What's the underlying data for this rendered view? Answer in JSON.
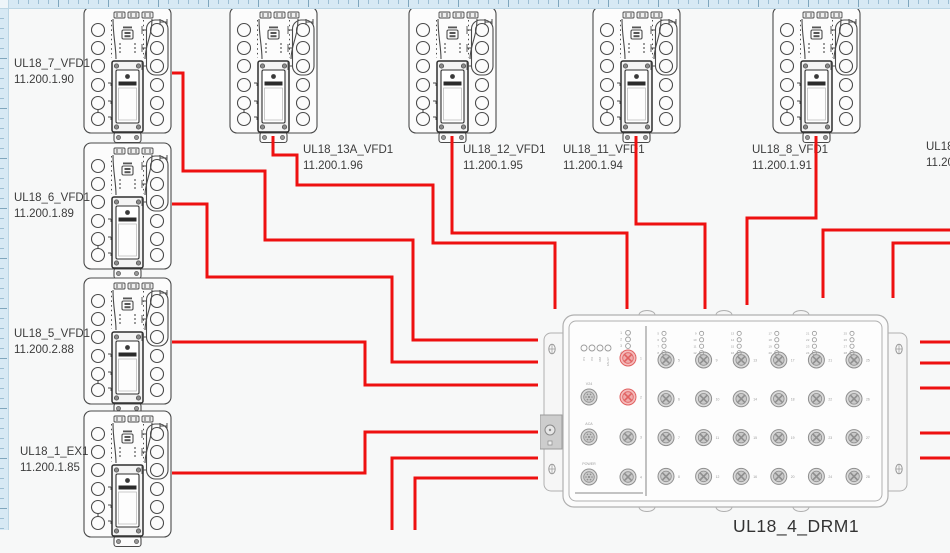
{
  "app": {
    "canvas_bg": "#f7f8f8",
    "ruler_color": "#d7e9f4",
    "outline_color": "#454545",
    "drm_outline_color": "#b0b0b0",
    "label_color": "#3c3c3c"
  },
  "devices": [
    {
      "name": "UL18_7_VFD1",
      "ip": "11.200.1.90",
      "x": 83,
      "y": 6,
      "label_x": 14,
      "label_y": 57
    },
    {
      "name": "UL18_6_VFD1",
      "ip": "11.200.1.89",
      "x": 83,
      "y": 142,
      "label_x": 14,
      "label_y": 191
    },
    {
      "name": "UL18_5_VFD1",
      "ip": "11.200.2.88",
      "x": 83,
      "y": 277,
      "label_x": 14,
      "label_y": 327
    },
    {
      "name": "UL18_1_EX1",
      "ip": "11.200.1.85",
      "x": 83,
      "y": 410,
      "label_x": 20,
      "label_y": 445
    },
    {
      "name": "UL18_13A_VFD1",
      "ip": "11.200.1.96",
      "x": 229,
      "y": 6,
      "label_x": 303,
      "label_y": 143
    },
    {
      "name": "UL18_12_VFD1",
      "ip": "11.200.1.95",
      "x": 408,
      "y": 6,
      "label_x": 463,
      "label_y": 143
    },
    {
      "name": "UL18_11_VFD1",
      "ip": "11.200.1.94",
      "x": 592,
      "y": 6,
      "label_x": 563,
      "label_y": 143
    },
    {
      "name": "UL18_8_VFD1",
      "ip": "11.200.1.91",
      "x": 772,
      "y": 6,
      "label_x": 752,
      "label_y": 143
    }
  ],
  "partial_device_label": {
    "name": "UL18",
    "ip": "11.20",
    "label_x": 926,
    "label_y": 140
  },
  "drm": {
    "title": "UL18_4_DRM1",
    "status_leds": [
      "P1",
      "P2",
      "RM",
      "FAULT"
    ],
    "left_led_numbers": [
      1,
      2,
      3,
      4
    ],
    "aux_port_labels": [
      "V24",
      "ACA",
      "POWER"
    ],
    "uplink_port_numbers": [
      1,
      2,
      3,
      4
    ],
    "highlighted_ports": [
      1,
      2
    ],
    "highlight_color": "#e06060",
    "highlight_fill": "#f5bcbc",
    "main_ports_first": 5,
    "main_ports_last": 28,
    "main_port_cols": 6,
    "main_port_rows": 4
  },
  "cables": {
    "color": "#ee1010",
    "width": 3,
    "routes": [
      {
        "id": "cable-ul18-7",
        "points": [
          [
            172,
            73
          ],
          [
            183,
            73
          ],
          [
            183,
            171
          ],
          [
            265,
            171
          ],
          [
            265,
            240
          ],
          [
            413,
            240
          ],
          [
            413,
            340
          ],
          [
            538,
            340
          ]
        ]
      },
      {
        "id": "cable-ul18-6",
        "points": [
          [
            172,
            204
          ],
          [
            207,
            204
          ],
          [
            207,
            277
          ],
          [
            392,
            277
          ],
          [
            392,
            362
          ],
          [
            538,
            362
          ]
        ]
      },
      {
        "id": "cable-ul18-5",
        "points": [
          [
            172,
            342
          ],
          [
            365,
            342
          ],
          [
            365,
            385
          ],
          [
            538,
            385
          ]
        ]
      },
      {
        "id": "cable-ul18-1",
        "points": [
          [
            172,
            473
          ],
          [
            365,
            473
          ],
          [
            365,
            432
          ],
          [
            538,
            432
          ]
        ]
      },
      {
        "id": "cable-ul18-13a",
        "points": [
          [
            273,
            136
          ],
          [
            273,
            155
          ],
          [
            297,
            155
          ],
          [
            297,
            185
          ],
          [
            433,
            185
          ],
          [
            433,
            243
          ],
          [
            555,
            243
          ],
          [
            555,
            309
          ]
        ]
      },
      {
        "id": "cable-ul18-12",
        "points": [
          [
            452,
            136
          ],
          [
            452,
            233
          ],
          [
            627,
            233
          ],
          [
            627,
            309
          ]
        ]
      },
      {
        "id": "cable-ul18-11",
        "points": [
          [
            636,
            136
          ],
          [
            636,
            224
          ],
          [
            705,
            224
          ],
          [
            705,
            309
          ]
        ]
      },
      {
        "id": "cable-ul18-8",
        "points": [
          [
            816,
            136
          ],
          [
            816,
            218
          ],
          [
            747,
            218
          ],
          [
            747,
            305
          ]
        ]
      },
      {
        "id": "cable-right-1",
        "points": [
          [
            950,
            230
          ],
          [
            823,
            230
          ],
          [
            823,
            298
          ]
        ]
      },
      {
        "id": "cable-right-2",
        "points": [
          [
            950,
            243
          ],
          [
            893,
            243
          ],
          [
            893,
            298
          ]
        ]
      },
      {
        "id": "cable-bottom-1",
        "points": [
          [
            392,
            530
          ],
          [
            392,
            458
          ],
          [
            538,
            458
          ]
        ]
      },
      {
        "id": "cable-bottom-2",
        "points": [
          [
            415,
            530
          ],
          [
            415,
            478
          ],
          [
            538,
            478
          ]
        ]
      },
      {
        "id": "cable-stub-1",
        "points": [
          [
            920,
            342
          ],
          [
            950,
            342
          ]
        ]
      },
      {
        "id": "cable-stub-2",
        "points": [
          [
            920,
            363
          ],
          [
            950,
            363
          ]
        ]
      },
      {
        "id": "cable-stub-3",
        "points": [
          [
            920,
            388
          ],
          [
            950,
            388
          ]
        ]
      },
      {
        "id": "cable-stub-4",
        "points": [
          [
            920,
            433
          ],
          [
            950,
            433
          ]
        ]
      },
      {
        "id": "cable-stub-5",
        "points": [
          [
            920,
            458
          ],
          [
            950,
            458
          ]
        ]
      }
    ]
  }
}
